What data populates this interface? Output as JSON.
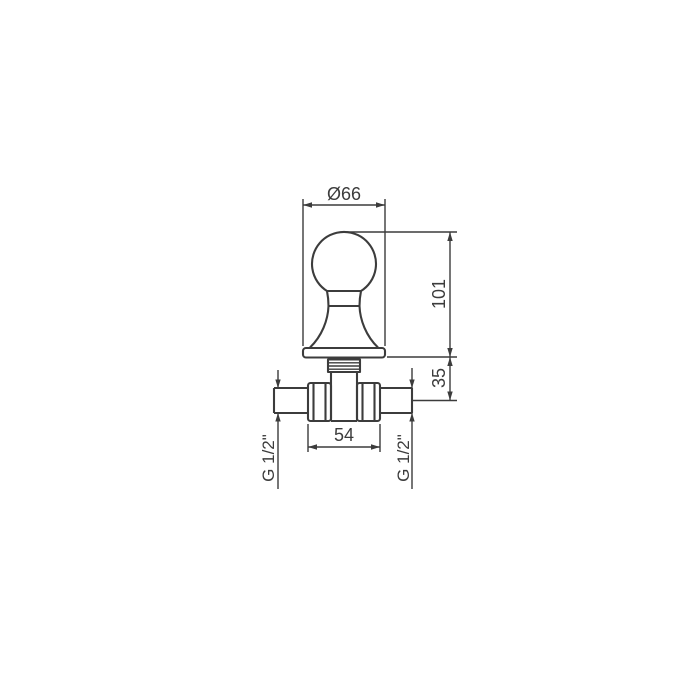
{
  "drawing": {
    "subject": "wall-mounted stop valve with ball knob handle, front elevation",
    "background": "#ffffff",
    "line_color": "#3c3c3c",
    "labels": {
      "knob_plate_diameter": "Ø66",
      "total_height": "101",
      "body_depth": "35",
      "body_width": "54",
      "thread_left": "G 1/2\"",
      "thread_right": "G 1/2\""
    }
  }
}
